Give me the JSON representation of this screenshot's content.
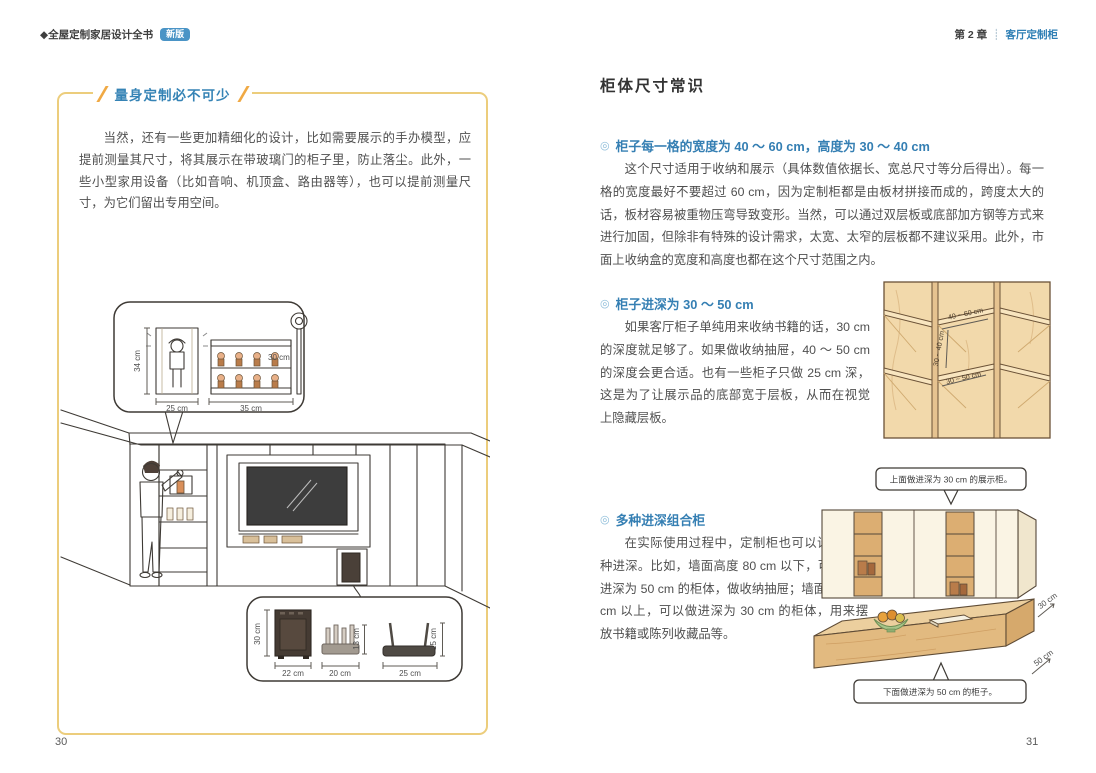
{
  "header": {
    "book_title": "◆全屋定制家居设计全书",
    "edition_badge": "新版",
    "chapter": "第 2 章",
    "divider": "┊",
    "chapter_section": "客厅定制柜"
  },
  "left_page": {
    "page_number": "30",
    "section_title": "量身定制必不可少",
    "paragraph": "当然，还有一些更加精细化的设计，比如需要展示的手办模型，应提前测量其尺寸，将其展示在带玻璃门的柜子里，防止落尘。此外，一些小型家用设备（比如音响、机顶盒、路由器等），也可以提前测量尺寸，为它们留出专用空间。",
    "figure": {
      "case_height": "34 cm",
      "case_width": "25 cm",
      "shelf_width": "35 cm",
      "staff_height": "30 cm",
      "speaker_height": "30 cm",
      "speaker_width": "22 cm",
      "router_a_height": "13 cm",
      "router_a_width": "20 cm",
      "router_b_height": "15 cm",
      "router_b_width": "25 cm"
    }
  },
  "right_page": {
    "page_number": "31",
    "heading": "柜体尺寸常识",
    "bullet": "◎",
    "sections": [
      {
        "title": "柜子每一格的宽度为 40 ～ 60 cm，高度为 30 ～ 40 cm",
        "body": "这个尺寸适用于收纳和展示（具体数值依据长、宽总尺寸等分后得出）。每一格的宽度最好不要超过 60 cm，因为定制柜都是由板材拼接而成的，跨度太大的话，板材容易被重物压弯导致变形。当然，可以通过双层板或底部加方钢等方式来进行加固，但除非有特殊的设计需求，太宽、太窄的层板都不建议采用。此外，市面上收纳盒的宽度和高度也都在这个尺寸范围之内。"
      },
      {
        "title": "柜子进深为 30 ～ 50 cm",
        "body": "如果客厅柜子单纯用来收纳书籍的话，30 cm 的深度就足够了。如果做收纳抽屉，40 ～ 50 cm 的深度会更合适。也有一些柜子只做 25 cm 深，这是为了让展示品的底部宽于层板，从而在视觉上隐藏层板。"
      },
      {
        "title": "多种进深组合柜",
        "body": "在实际使用过程中，定制柜也可以设计为多种进深。比如，墙面高度 80 cm 以下，可以定制进深为 50 cm 的柜体，做收纳抽屉；墙面高度 80 cm 以上，可以做进深为 30 cm 的柜体，用来摆放书籍或陈列收藏品等。"
      }
    ],
    "cabinet_figure": {
      "width_label": "40 ~ 60 cm",
      "height_label": "30 ~ 40 cm",
      "depth_label": "30 ~ 50 cm"
    },
    "combo_figure": {
      "top_callout": "上面做进深为 30 cm 的展示柜。",
      "top_depth": "30 cm",
      "bottom_depth": "50 cm",
      "bottom_callout": "下面做进深为 50 cm 的柜子。"
    }
  }
}
